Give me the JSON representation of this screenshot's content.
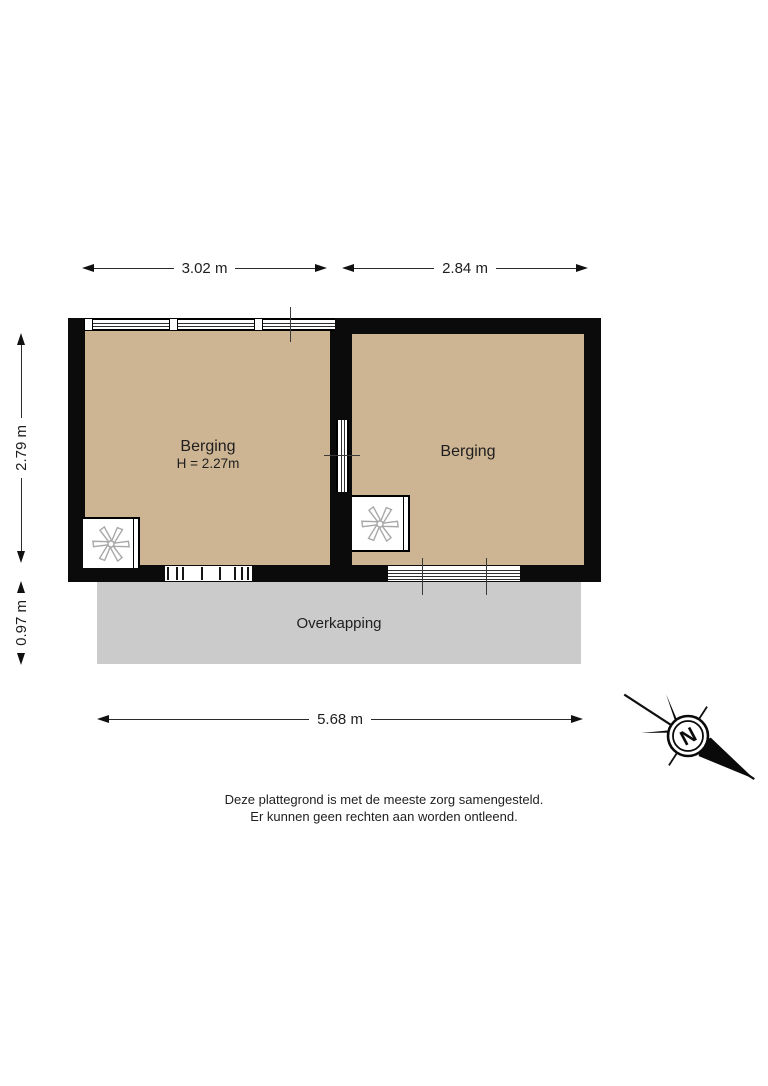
{
  "colors": {
    "floor": "#cdb493",
    "canopy": "#cbcbcb",
    "wall": "#0b0b0b",
    "text": "#1e1e1e",
    "fan": "#a8a8a8"
  },
  "dimensions": {
    "top_left": "3.02 m",
    "top_right": "2.84 m",
    "left_upper": "2.79 m",
    "left_lower": "0.97 m",
    "bottom": "5.68 m"
  },
  "rooms": {
    "left": {
      "name": "Berging",
      "height_note": "H = 2.27m"
    },
    "right": {
      "name": "Berging"
    },
    "canopy": {
      "name": "Overkapping"
    }
  },
  "compass": {
    "label": "N"
  },
  "icons": {
    "fan": "extractor-fan-icon",
    "compass": "north-arrow-compass"
  },
  "footer": {
    "line1": "Deze plattegrond is met de meeste zorg samengesteld.",
    "line2": "Er kunnen geen rechten aan worden ontleend."
  }
}
